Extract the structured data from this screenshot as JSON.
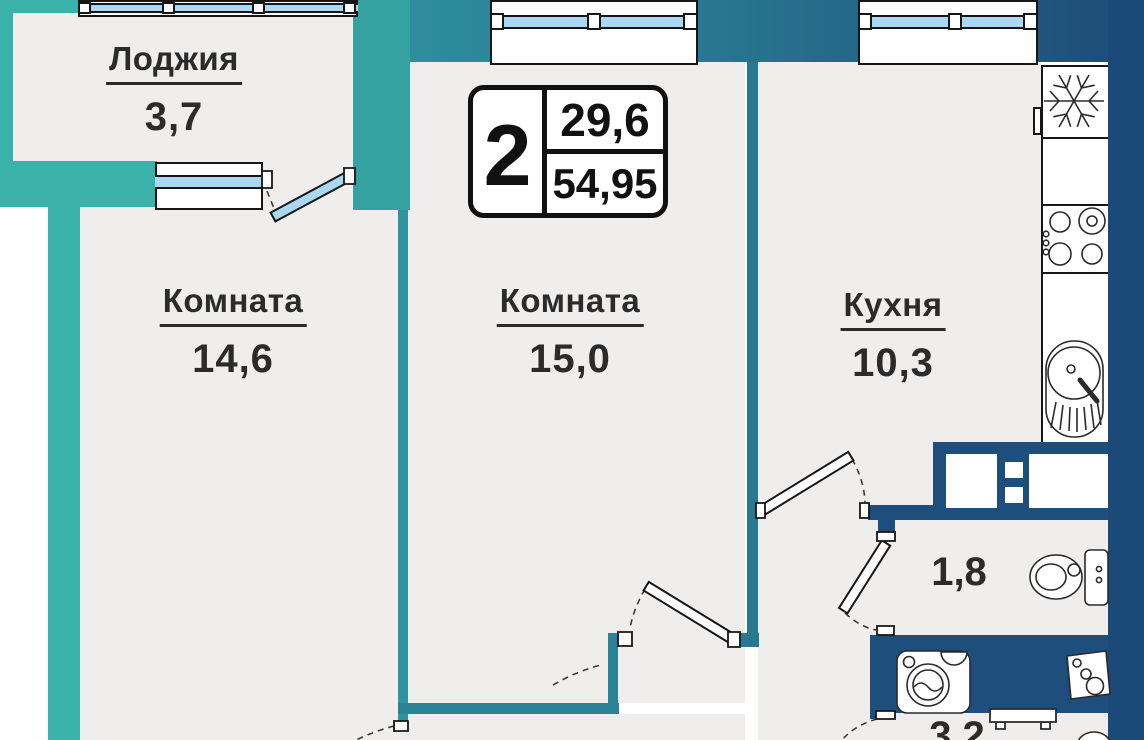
{
  "badge": {
    "rooms_count": "2",
    "living_area": "29,6",
    "total_area": "54,95"
  },
  "rooms": {
    "loggia": {
      "name": "Лоджия",
      "area": "3,7"
    },
    "room1": {
      "name": "Комната",
      "area": "14,6"
    },
    "room2": {
      "name": "Комната",
      "area": "15,0"
    },
    "kitchen": {
      "name": "Кухня",
      "area": "10,3"
    },
    "wc": {
      "area": "1,8"
    },
    "bathroom": {
      "area": "3,2"
    }
  },
  "fixtures": [
    "fridge-snowflake-icon",
    "stove-burners-icon",
    "kitchen-sink-icon",
    "toilet-icon",
    "washing-machine-icon",
    "bath-sink-icon",
    "towel-rail-icon"
  ],
  "colors": {
    "wall_teal": "#3ab2a9",
    "wall_navy": "#1e4e7c",
    "glass": "#a9d9f2",
    "floor": "#efeeed",
    "line": "#161616",
    "text": "#2b2b2b"
  }
}
